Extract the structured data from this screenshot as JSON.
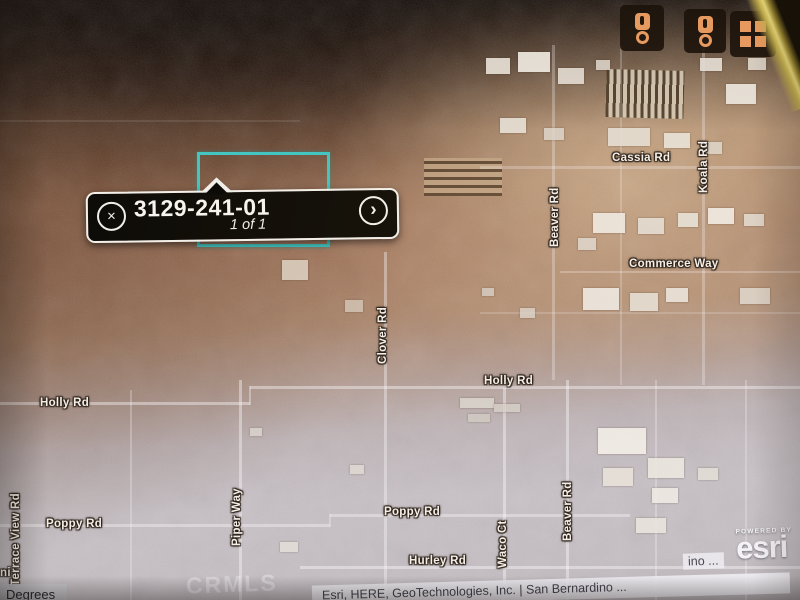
{
  "popup": {
    "parcel_id": "3129-241-01",
    "page_indicator": "1 of 1",
    "close_glyph": "×",
    "next_glyph": "›"
  },
  "map_controls": {
    "buttons": [
      {
        "id": "locate-marker-1",
        "icon": "map-pin-icon"
      },
      {
        "id": "locate-marker-2",
        "icon": "map-pin-icon"
      },
      {
        "id": "basemap-grid",
        "icon": "grid-icon"
      }
    ]
  },
  "road_labels": [
    {
      "text": "Cassia Rd",
      "x": 612,
      "y": 152,
      "vertical": false
    },
    {
      "text": "Koala Rd",
      "x": 698,
      "y": 193,
      "vertical": true
    },
    {
      "text": "Beaver Rd",
      "x": 549,
      "y": 247,
      "vertical": true
    },
    {
      "text": "Commerce Way",
      "x": 629,
      "y": 258,
      "vertical": false
    },
    {
      "text": "Clover Rd",
      "x": 377,
      "y": 364,
      "vertical": true
    },
    {
      "text": "Holly Rd",
      "x": 484,
      "y": 375,
      "vertical": false
    },
    {
      "text": "Holly Rd",
      "x": 40,
      "y": 397,
      "vertical": false
    },
    {
      "text": "Terrace View Rd",
      "x": 10,
      "y": 586,
      "vertical": true
    },
    {
      "text": "Piper Way",
      "x": 231,
      "y": 546,
      "vertical": true
    },
    {
      "text": "Poppy Rd",
      "x": 46,
      "y": 518,
      "vertical": false
    },
    {
      "text": "Poppy Rd",
      "x": 384,
      "y": 506,
      "vertical": false
    },
    {
      "text": "Waco Ct",
      "x": 497,
      "y": 568,
      "vertical": true
    },
    {
      "text": "Beaver Rd",
      "x": 562,
      "y": 541,
      "vertical": true
    },
    {
      "text": "Hurley Rd",
      "x": 409,
      "y": 555,
      "vertical": false
    },
    {
      "text": "ni",
      "x": 0,
      "y": 567,
      "vertical": false
    }
  ],
  "watermark": "CRMLS",
  "attribution": {
    "text": "Esri, HERE, GeoTechnologies, Inc. | San Bernardino ...",
    "overflow_fragment": "ino ..."
  },
  "esri_logo": {
    "powered_by": "POWERED BY",
    "brand": "esri"
  },
  "coordinate_widget": {
    "label": "Degrees"
  },
  "colors": {
    "parcel_outline": "#43c6c2",
    "popup_background": "#0e0c08",
    "control_icon": "#e79a5f",
    "road_label_text": "#f5efe8",
    "attribution_text": "#41414b"
  }
}
